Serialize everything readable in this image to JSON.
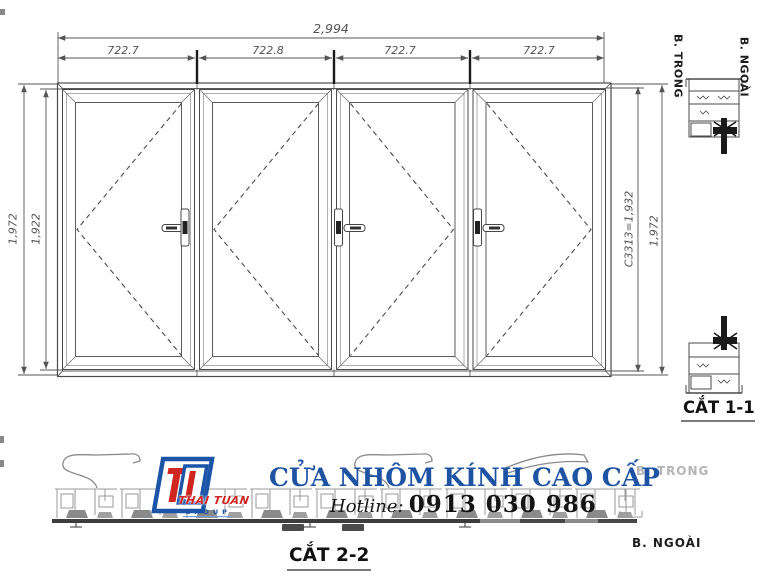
{
  "drawing": {
    "dimensions": {
      "total_width": "2,994",
      "panel_widths": [
        "722.7",
        "722.8",
        "722.7",
        "722.7"
      ],
      "left_outer_height": "1,972",
      "left_inner_height": "1,922",
      "right_inner_height": "C3313=1,932",
      "right_outer_height": "1,972"
    },
    "sections": {
      "section_1_label": "CẮT 1-1",
      "section_2_label": "CẮT 2-2",
      "top_side_inner": "B. TRONG",
      "top_side_outer": "B. NGOÀI",
      "bottom_side_inner": "B. TRONG",
      "bottom_side_outer": "B. NGOÀI"
    }
  },
  "footer": {
    "title": "CỬA NHÔM KÍNH CAO CẤP",
    "hotline_label": "Hotline:",
    "hotline_number": "0913 030 986"
  },
  "logo": {
    "brand": "THAI TUAN",
    "group": "GROUP"
  },
  "colors": {
    "title_blue": "#1e53a4",
    "brand_red": "#cf2621",
    "logo_blue": "#1c55a8",
    "line_dark": "#4a4a4a",
    "line_gray": "#9a9a9a",
    "muted_label": "#b5b5b5"
  }
}
